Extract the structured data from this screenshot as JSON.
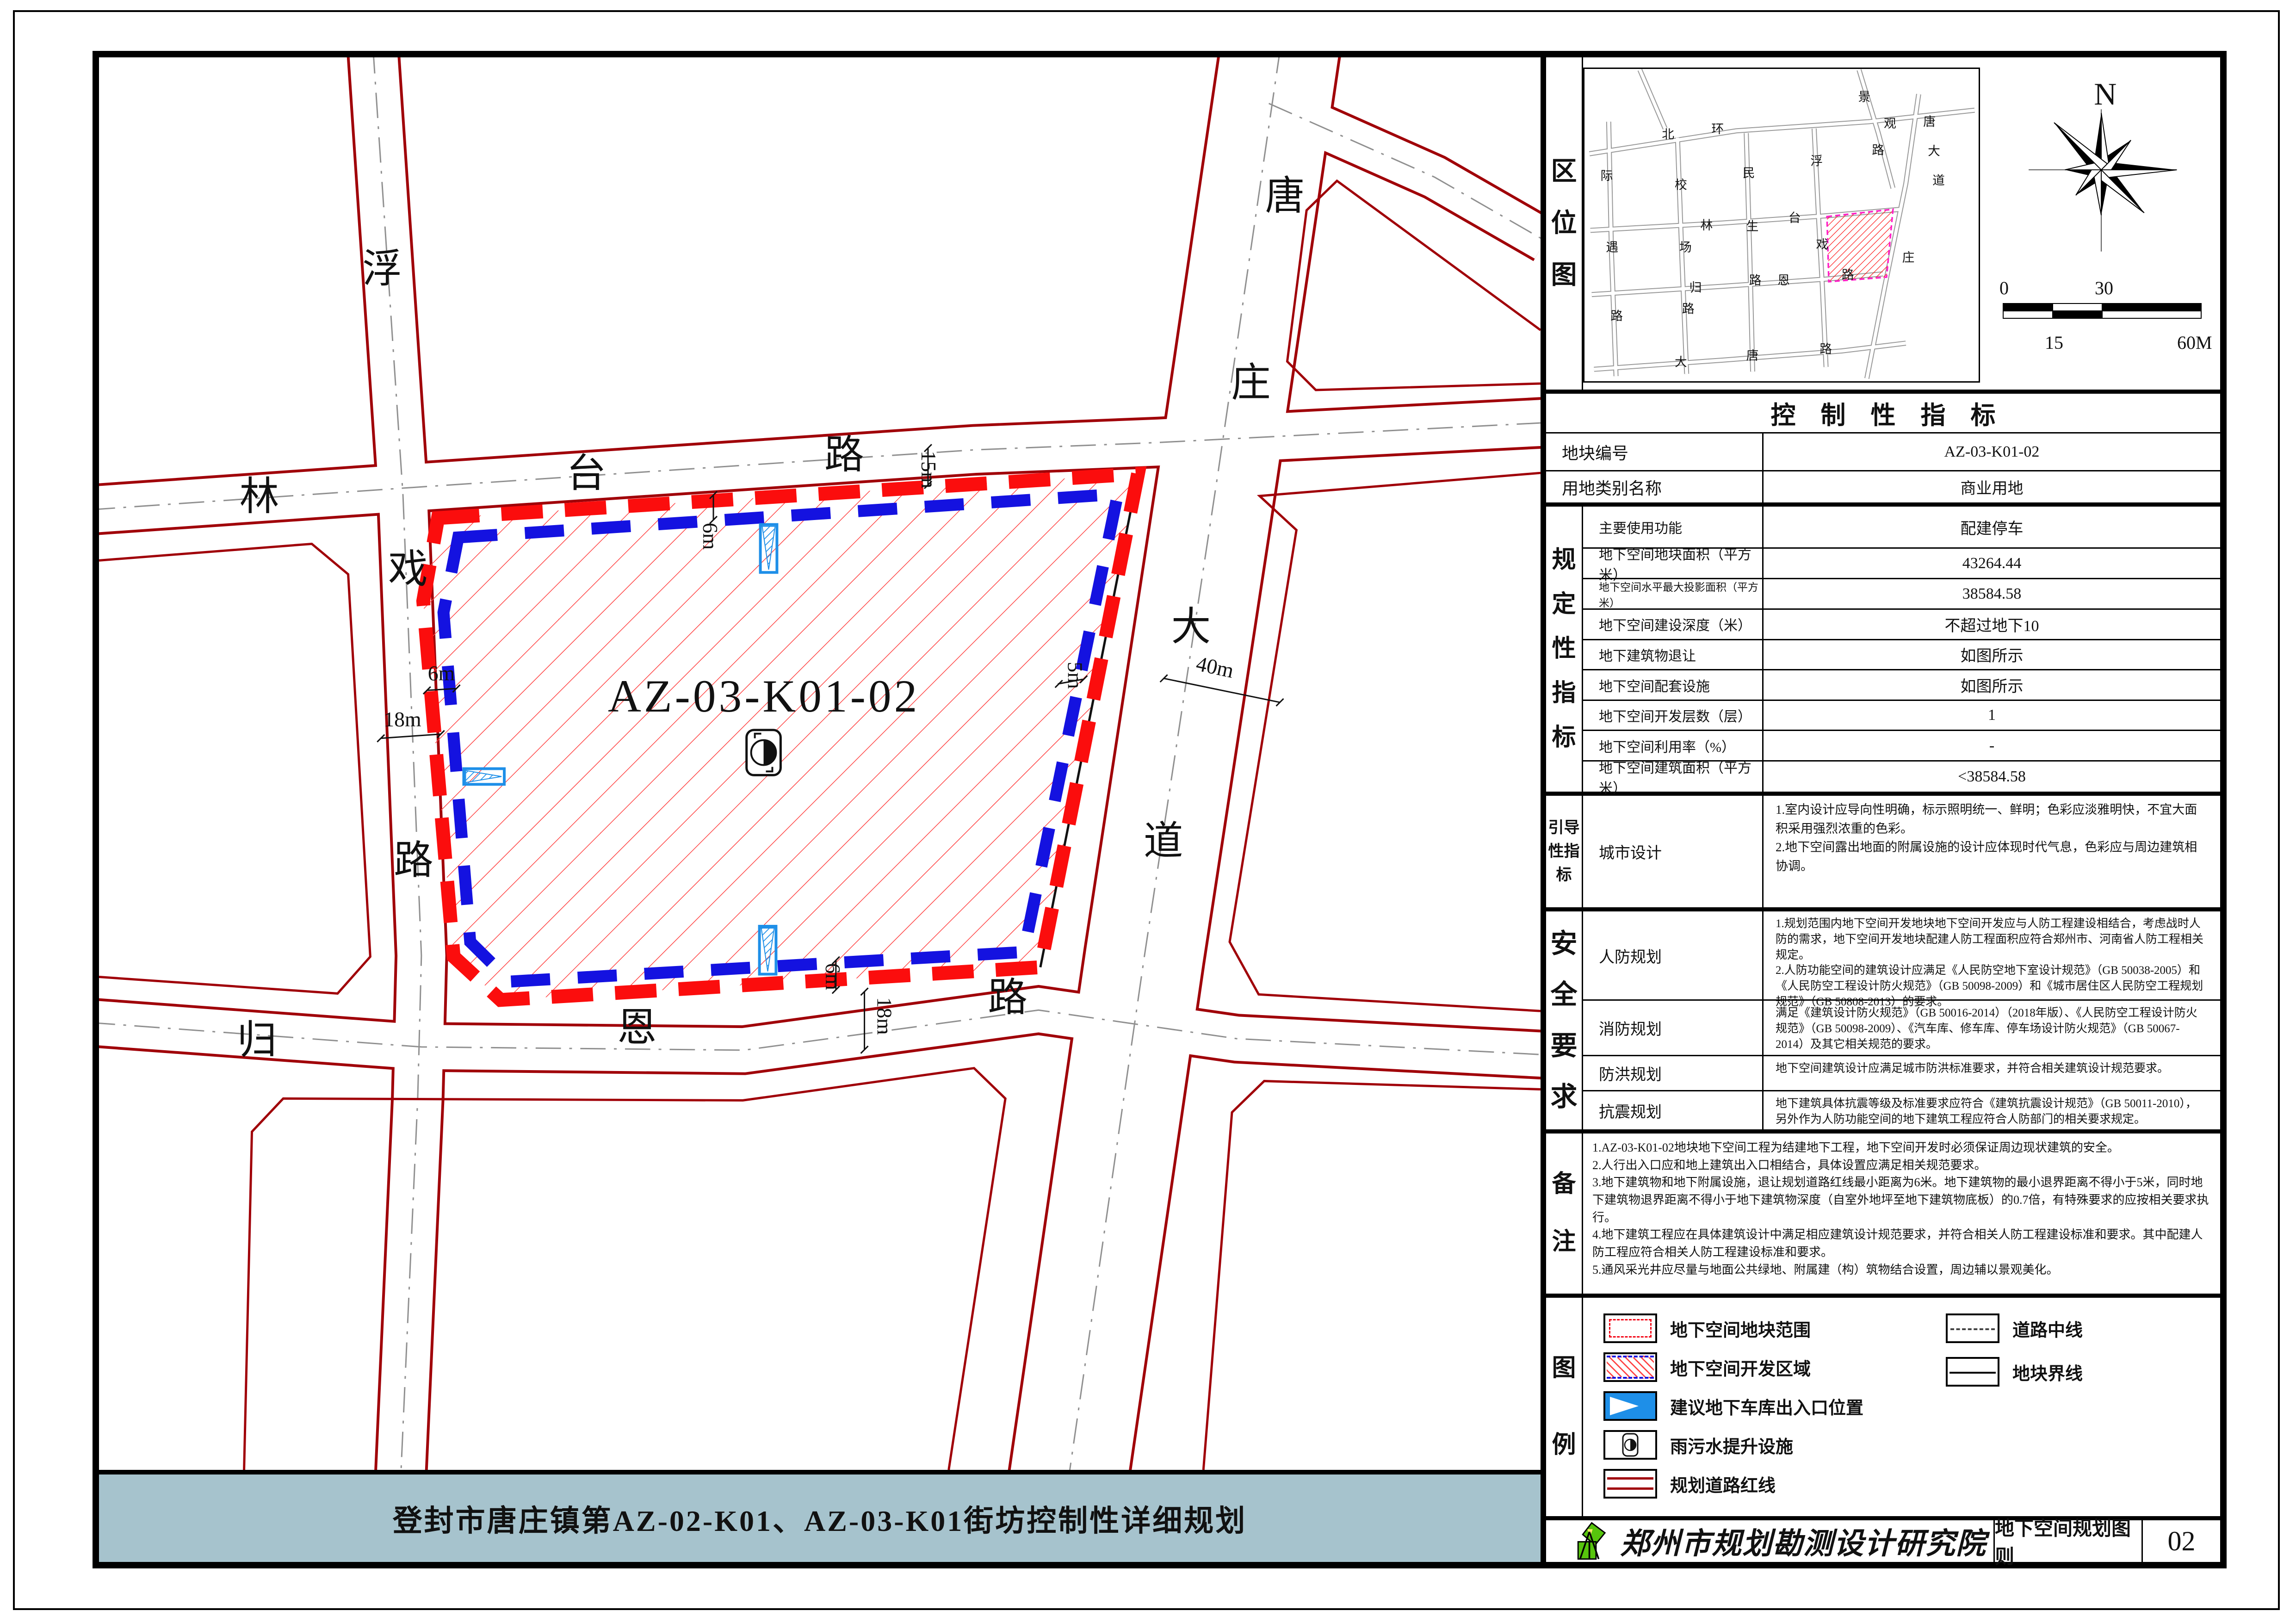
{
  "title": "登封市唐庄镇第AZ-02-K01、AZ-03-K01街坊控制性详细规划",
  "map": {
    "plot": "AZ-03-K01-02",
    "roads": [
      "浮",
      "戏",
      "路",
      "林",
      "台",
      "路",
      "归",
      "恩",
      "路",
      "唐",
      "庄",
      "大",
      "道"
    ],
    "dims": [
      "6m",
      "18m",
      "6m",
      "15m",
      "5m",
      "40m",
      "6m",
      "18m"
    ]
  },
  "mini": {
    "label": "区位图",
    "names": [
      "北",
      "环",
      "景",
      "观",
      "路",
      "唐",
      "大",
      "道",
      "庄",
      "际",
      "遇",
      "路",
      "校",
      "场",
      "路",
      "民",
      "生",
      "路",
      "浮",
      "戏",
      "林",
      "台",
      "归",
      "恩",
      "路",
      "大",
      "唐",
      "路"
    ]
  },
  "compass": {
    "n": "N"
  },
  "scale": {
    "t0": "0",
    "t30": "30",
    "b15": "15",
    "b60": "60M"
  },
  "sec": {
    "reg": "规定性指标",
    "guide": "引导性指标",
    "safe": "安全要求",
    "note": "备注",
    "leg": "图例"
  },
  "tbl": {
    "title": "控制性指标",
    "plain": [
      {
        "k": "地块编号",
        "v": "AZ-03-K01-02"
      },
      {
        "k": "用地类别名称",
        "v": "商业用地"
      }
    ],
    "reg": [
      {
        "k": "主要使用功能",
        "v": "配建停车"
      },
      {
        "k": "地下空间地块面积（平方米）",
        "v": "43264.44"
      },
      {
        "k": "地下空间水平最大投影面积（平方米）",
        "v": "38584.58"
      },
      {
        "k": "地下空间建设深度（米）",
        "v": "不超过地下10"
      },
      {
        "k": "地下建筑物退让",
        "v": "如图所示"
      },
      {
        "k": "地下空间配套设施",
        "v": "如图所示"
      },
      {
        "k": "地下空间开发层数（层）",
        "v": "1"
      },
      {
        "k": "地下空间利用率（%）",
        "v": "-"
      },
      {
        "k": "地下空间建筑面积（平方米）",
        "v": "<38584.58"
      }
    ]
  },
  "guide": {
    "k": "城市设计",
    "v1": "1.室内设计应导向性明确，标示照明统一、鲜明；色彩应淡雅明快，不宜大面积采用强烈浓重的色彩。",
    "v2": "2.地下空间露出地面的附属设施的设计应体现时代气息，色彩应与周边建筑相协调。"
  },
  "safe": [
    {
      "k": "人防规划",
      "v1": "1.规划范围内地下空间开发地块地下空间开发应与人防工程建设相结合，考虑战时人防的需求，地下空间开发地块配建人防工程面积应符合郑州市、河南省人防工程相关规定。",
      "v2": "2.人防功能空间的建筑设计应满足《人民防空地下室设计规范》（GB 50038-2005）和《人民防空工程设计防火规范》（GB 50098-2009）和《城市居住区人民防空工程规划规范》（GB 50808-2013）的要求。"
    },
    {
      "k": "消防规划",
      "v1": "满足《建筑设计防火规范》（GB 50016-2014）（2018年版）、《人民防空工程设计防火规范》（GB 50098-2009）、《汽车库、修车库、停车场设计防火规范》（GB 50067-2014）及其它相关规范的要求。",
      "v2": ""
    },
    {
      "k": "防洪规划",
      "v1": "地下空间建筑设计应满足城市防洪标准要求，并符合相关建筑设计规范要求。",
      "v2": ""
    },
    {
      "k": "抗震规划",
      "v1": "地下建筑具体抗震等级及标准要求应符合《建筑抗震设计规范》（GB 50011-2010），另外作为人防功能空间的地下建筑工程应符合人防部门的相关要求规定。",
      "v2": ""
    }
  ],
  "notes": [
    "1.AZ-03-K01-02地块地下空间工程为结建地下工程，地下空间开发时必须保证周边现状建筑的安全。",
    "2.人行出入口应和地上建筑出入口相结合，具体设置应满足相关规范要求。",
    "3.地下建筑物和地下附属设施，退让规划道路红线最小距离为6米。地下建筑物的最小退界距离不得小于5米，同时地下建筑物退界距离不得小于地下建筑物深度（自室外地坪至地下建筑物底板）的0.7倍，有特殊要求的应按相关要求执行。",
    "4.地下建筑工程应在具体建筑设计中满足相应建筑设计规范要求，并符合相关人防工程建设标准和要求。其中配建人防工程应符合相关人防工程建设标准和要求。",
    "5.通风采光井应尽量与地面公共绿地、附属建（构）筑物结合设置，周边辅以景观美化。"
  ],
  "legend": {
    "left": [
      "地下空间地块范围",
      "地下空间开发区域",
      "建议地下车库出入口位置",
      "雨污水提升设施",
      "规划道路红线"
    ],
    "right": [
      "道路中线",
      "地块界线"
    ]
  },
  "tb": {
    "org": "郑州市规划勘测设计研究院",
    "sheet": "地下空间规划图则",
    "num": "02"
  },
  "colors": {
    "accent": "#a6c3cd",
    "road_red": "#a00008",
    "plot_dash": "#fb0d0d",
    "dev_dash": "#1412e0",
    "entry_blue": "#1e8fe8",
    "logo_green": "#57c50d"
  }
}
